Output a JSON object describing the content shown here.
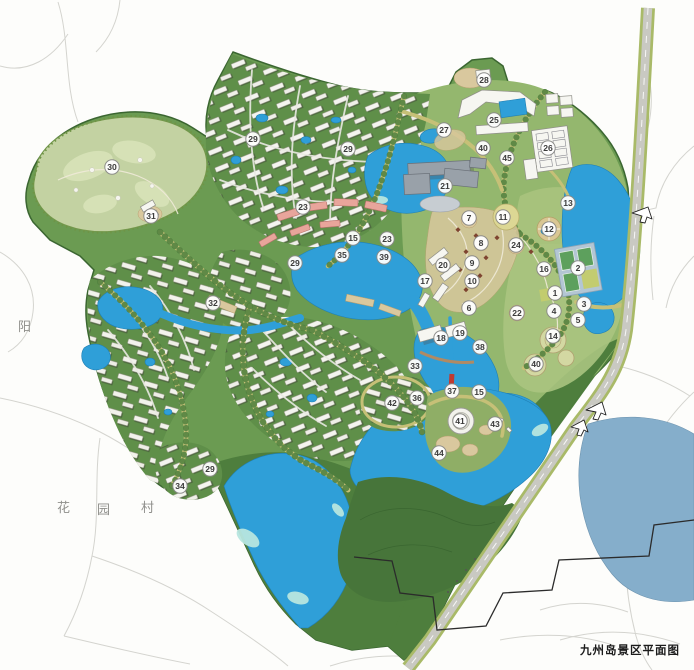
{
  "map": {
    "caption": "九州岛景区平面图",
    "area_labels": [
      {
        "text": "花",
        "x": 57,
        "y": 512
      },
      {
        "text": "园",
        "x": 97,
        "y": 514
      },
      {
        "text": "村",
        "x": 141,
        "y": 512
      },
      {
        "text": "阳",
        "x": 18,
        "y": 331
      }
    ],
    "markers": [
      {
        "n": "1",
        "x": 555,
        "y": 293
      },
      {
        "n": "2",
        "x": 578,
        "y": 268
      },
      {
        "n": "3",
        "x": 584,
        "y": 304
      },
      {
        "n": "4",
        "x": 554,
        "y": 311
      },
      {
        "n": "5",
        "x": 578,
        "y": 320
      },
      {
        "n": "6",
        "x": 469,
        "y": 308
      },
      {
        "n": "7",
        "x": 469,
        "y": 218
      },
      {
        "n": "8",
        "x": 481,
        "y": 243
      },
      {
        "n": "9",
        "x": 472,
        "y": 263
      },
      {
        "n": "10",
        "x": 472,
        "y": 281
      },
      {
        "n": "11",
        "x": 503,
        "y": 217
      },
      {
        "n": "12",
        "x": 549,
        "y": 229
      },
      {
        "n": "13",
        "x": 568,
        "y": 203
      },
      {
        "n": "14",
        "x": 553,
        "y": 336
      },
      {
        "n": "15",
        "x": 353,
        "y": 238
      },
      {
        "n": "15",
        "x": 479,
        "y": 392
      },
      {
        "n": "16",
        "x": 544,
        "y": 269
      },
      {
        "n": "17",
        "x": 425,
        "y": 281
      },
      {
        "n": "18",
        "x": 441,
        "y": 338
      },
      {
        "n": "19",
        "x": 460,
        "y": 333
      },
      {
        "n": "20",
        "x": 443,
        "y": 265
      },
      {
        "n": "21",
        "x": 445,
        "y": 186
      },
      {
        "n": "22",
        "x": 517,
        "y": 313
      },
      {
        "n": "23",
        "x": 303,
        "y": 207
      },
      {
        "n": "23",
        "x": 387,
        "y": 239
      },
      {
        "n": "24",
        "x": 516,
        "y": 245
      },
      {
        "n": "25",
        "x": 494,
        "y": 120
      },
      {
        "n": "26",
        "x": 548,
        "y": 148
      },
      {
        "n": "27",
        "x": 444,
        "y": 130
      },
      {
        "n": "28",
        "x": 484,
        "y": 80
      },
      {
        "n": "29",
        "x": 253,
        "y": 139
      },
      {
        "n": "29",
        "x": 348,
        "y": 149
      },
      {
        "n": "29",
        "x": 295,
        "y": 263
      },
      {
        "n": "29",
        "x": 210,
        "y": 469
      },
      {
        "n": "30",
        "x": 112,
        "y": 167
      },
      {
        "n": "31",
        "x": 151,
        "y": 216
      },
      {
        "n": "32",
        "x": 213,
        "y": 303
      },
      {
        "n": "33",
        "x": 415,
        "y": 366
      },
      {
        "n": "34",
        "x": 180,
        "y": 486
      },
      {
        "n": "35",
        "x": 342,
        "y": 255
      },
      {
        "n": "36",
        "x": 417,
        "y": 398
      },
      {
        "n": "37",
        "x": 452,
        "y": 391
      },
      {
        "n": "38",
        "x": 480,
        "y": 347
      },
      {
        "n": "39",
        "x": 384,
        "y": 257
      },
      {
        "n": "40",
        "x": 483,
        "y": 148
      },
      {
        "n": "40",
        "x": 536,
        "y": 364
      },
      {
        "n": "41",
        "x": 460,
        "y": 421
      },
      {
        "n": "42",
        "x": 392,
        "y": 403
      },
      {
        "n": "43",
        "x": 495,
        "y": 424
      },
      {
        "n": "44",
        "x": 439,
        "y": 453
      },
      {
        "n": "45",
        "x": 507,
        "y": 158
      }
    ],
    "colors": {
      "background": "#fdfdfb",
      "site_green": "#6b9b52",
      "forest_green": "#4e7e3d",
      "villa_green": "#5f8f49",
      "golf_green": "#c3d2a2",
      "water_blue": "#2f9fd8",
      "water_shallow": "#b7e6df",
      "external_water": "#85aecb",
      "road_olive": "#c6c077",
      "road_gray": "#e9e9e2",
      "highway_gray": "#c9c9c2",
      "building_pink": "#e8a59b",
      "building_gray": "#99a1a9",
      "building_white": "#f6f6f1",
      "sand_tan": "#d9c89e",
      "marker_fill": "#ffffff",
      "marker_border": "#8a8a88",
      "marker_text": "#3c3c3c",
      "boundary_dark": "#2b2b2b",
      "context_line": "#d4d4cf",
      "label_gray": "#8f8f8b",
      "caption_black": "#1c1c1c",
      "accent_red": "#c03a32"
    }
  }
}
